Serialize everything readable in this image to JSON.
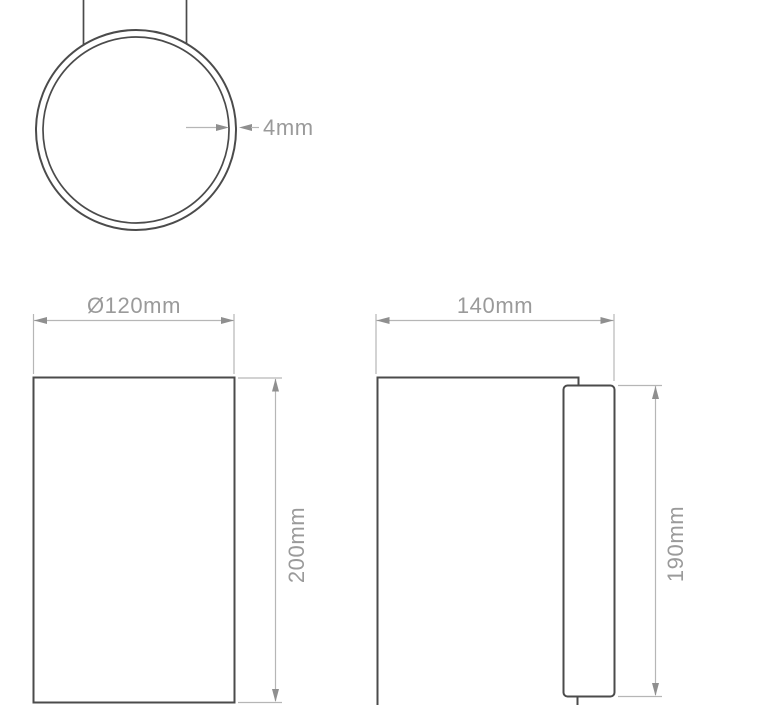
{
  "colors": {
    "shape_line": "#4b4b4b",
    "dimension_line": "#b6b6b6",
    "arrowhead": "#8f8f8f",
    "label_text": "#9a9a9a",
    "background": "#ffffff"
  },
  "figures": {
    "top_view": {
      "thickness_label": "4mm"
    },
    "front_view": {
      "width_label": "Ø120mm",
      "height_label": "200mm"
    },
    "side_view": {
      "width_label": "140mm",
      "height_label": "190mm"
    }
  }
}
